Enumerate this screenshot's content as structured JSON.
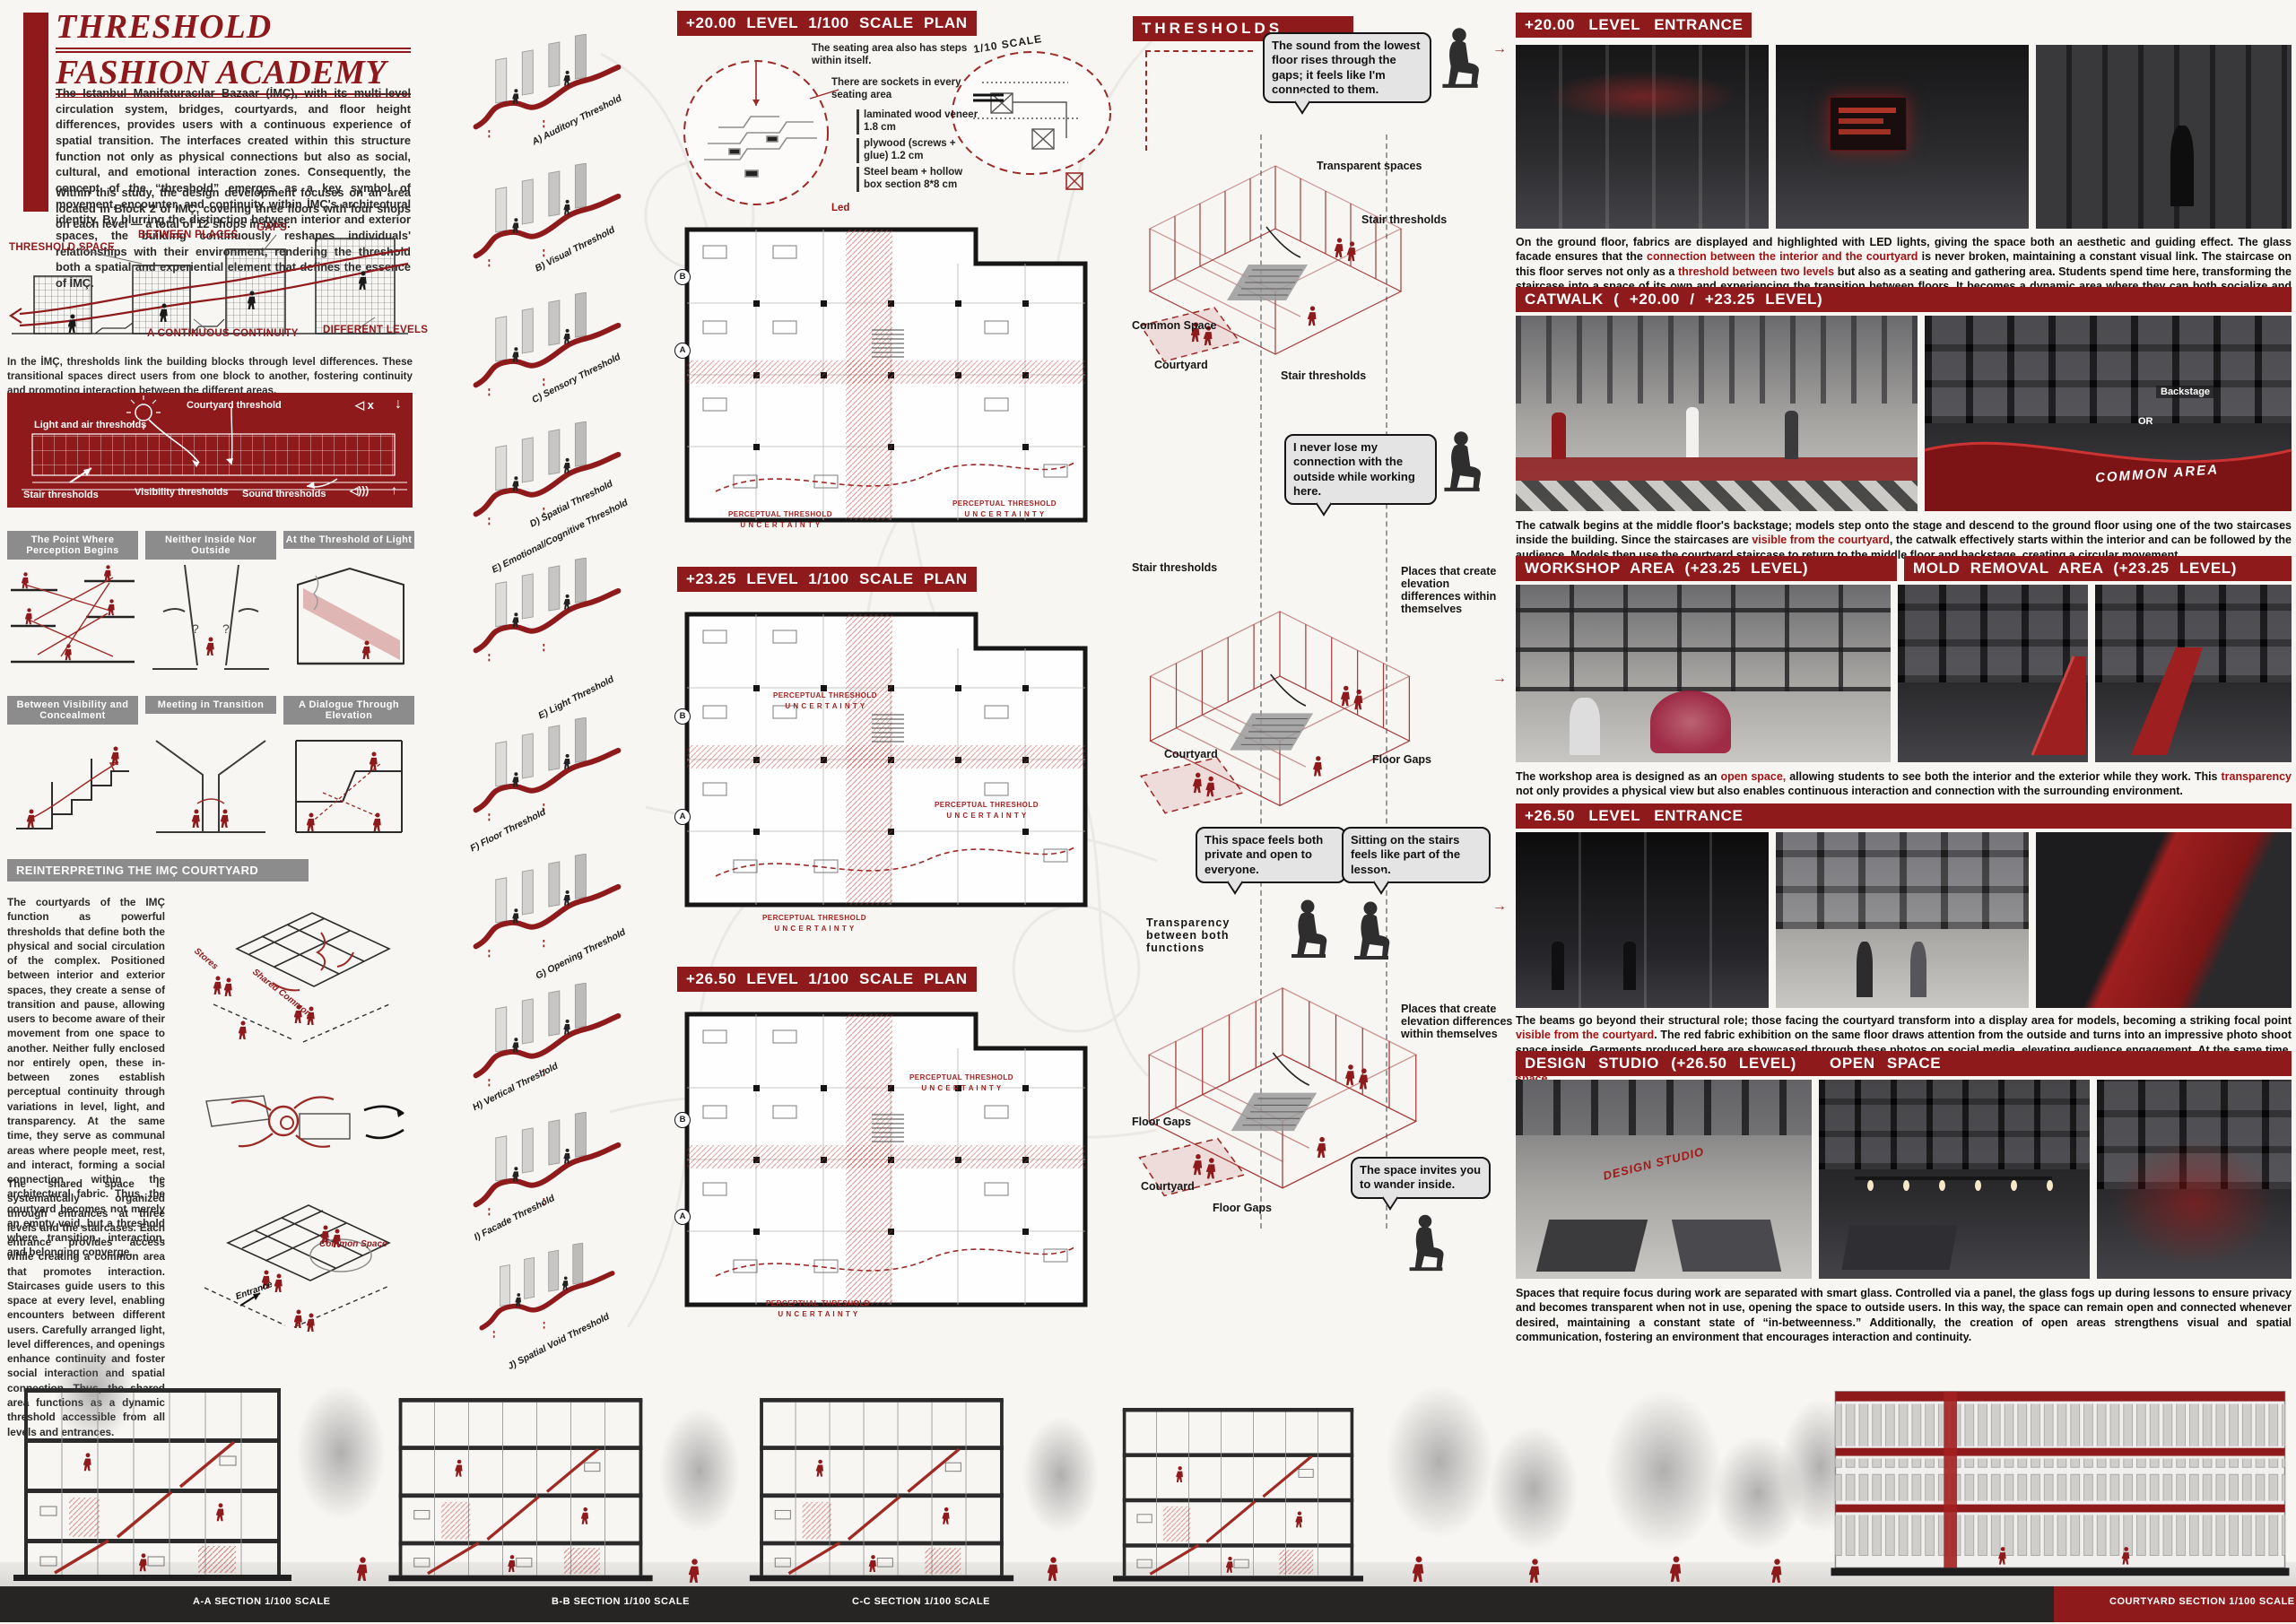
{
  "colors": {
    "maroon": "#8e1a1c",
    "sketch_red": "#9b2a26",
    "gray_header": "#8c8c8c"
  },
  "title": {
    "line1": "THRESHOLD",
    "line2": "FASHION ACADEMY"
  },
  "intro": {
    "p1": "The Istanbul Manifaturacılar Bazaar (İMÇ), with its multi-level circulation system, bridges, courtyards, and floor height differences, provides users with a continuous experience of spatial transition. The interfaces created within this structure function not only as physical connections but also as social, cultural, and emotional interaction zones. Consequently, the concept of the “threshold” emerges as a key symbol of movement, encounter, and continuity within İMÇ's architectural identity. By blurring the distinction between interior and exterior spaces, the building continuously reshapes individuals' relationships with their environment, rendering the threshold both a spatial and experiential element that defines the essence of İMÇ.",
    "p2": "Within this study, the design development focuses on an area located in Block 2 of İMÇ, covering three floors with four shops on each level — a total of 12 shops in total."
  },
  "concept": {
    "labels": [
      "THRESHOLD SPACE",
      "BETWEEN PLACES",
      "GAPS",
      "A CONTINUOUS CONTINUITY",
      "DIFFERENT LEVELS"
    ],
    "caption": "In the İMÇ, thresholds link the building blocks through level differences. These transitional spaces direct users from one block to another, fostering continuity and promoting interaction between the different areas."
  },
  "redband": {
    "labels": [
      "Courtyard threshold",
      "Light and air thresholds",
      "Stair thresholds",
      "Visibility thresholds",
      "Sound thresholds"
    ],
    "icon_mute": "◁ x",
    "icon_down": "↓",
    "icon_sound": "◁)))",
    "icon_up": "↑"
  },
  "panels": {
    "titles": [
      "The Point Where Perception Begins",
      "Neither Inside Nor Outside",
      "At the Threshold of Light",
      "Between Visibility and Concealment",
      "Meeting in Transition",
      "A Dialogue Through Elevation"
    ]
  },
  "reinterpret": {
    "title": "REINTERPRETING THE IMÇ COURTYARD",
    "p1": "The courtyards of the IMÇ function as powerful thresholds that define both the physical and social circulation of the complex. Positioned between interior and exterior spaces, they create a sense of transition and pause, allowing users to become aware of their movement from one space to another. Neither fully enclosed nor entirely open, these in-between zones establish perceptual continuity through variations in level, light, and transparency. At the same time, they serve as communal areas where people meet, rest, and interact, forming a social connection within the architectural fabric. Thus, the courtyard becomes not merely an empty void, but a threshold where transition, interaction, and belonging converge.",
    "p2": "The shared space is systematically organized through entrances at three levels and the staircases. Each entrance provides access while creating a common area that promotes interaction. Staircases guide users to this space at every level, enabling encounters between different users. Carefully arranged light, level differences, and openings enhance continuity and foster social interaction and spatial connection. Thus, the shared area functions as a dynamic threshold accessible from all levels and entrances.",
    "sk_stores": "Stores",
    "sk_shared": "Shared Common",
    "sk_common": "Common Space",
    "sk_entrance": "Entrance"
  },
  "axons": {
    "labels": [
      "A) Auditory Threshold",
      "B) Visual Threshold",
      "C) Sensory Threshold",
      "D) Spatial Threshold",
      "E) Emotional/Cognitive Threshold",
      "E) Light Threshold",
      "F) Floor Threshold",
      "G) Opening Threshold",
      "H) Vertical Threshold",
      "I) Facade Threshold",
      "J) Spatial Void Threshold"
    ]
  },
  "plans": {
    "p1_title": "+20.00 LEVEL 1/100 SCALE PLAN",
    "p2_title": "+23.25 LEVEL 1/100 SCALE PLAN",
    "p3_title": "+26.50 LEVEL 1/100 SCALE PLAN",
    "detail_scale": "1/10 SCALE",
    "note_steps": "The seating area also has steps within itself.",
    "note_sockets": "There are sockets in every seating area",
    "spec1": "laminated wood veneer 1.8 cm",
    "spec2": "plywood (screws + glue) 1.2 cm",
    "spec3": "Steel beam + hollow box section 8*8 cm",
    "led": "Led",
    "perceptual1": "PERCEPTUAL THRESHOLD",
    "perceptual2": "U N C E R T A I N T Y",
    "mark_a": "A",
    "mark_b": "B"
  },
  "thresholds": {
    "title": "THRESHOLDS",
    "bubble1": "The sound from the lowest floor rises through the gaps; it feels like I'm connected to them.",
    "bubble2": "I never lose my connection with the outside while working here.",
    "bubble3": "This space feels both private and open to everyone.",
    "bubble4": "Sitting on the stairs feels like part of the lesson.",
    "bubble5": "The space invites you to wander inside.",
    "l_transparent": "Transparent spaces",
    "l_stair": "Stair thresholds",
    "l_common": "Common Space",
    "l_courtyard": "Courtyard",
    "l_elev": "Places that create elevation differences within themselves",
    "l_floorgaps": "Floor Gaps",
    "l_transparency": "Transparency between both functions"
  },
  "right": {
    "h_entrance20": "+20.00 LEVEL ENTRANCE",
    "h_catwalk": "CATWALK ( +20.00 / +23.25 LEVEL)",
    "h_workshop": "WORKSHOP AREA (+23.25 LEVEL)",
    "h_mold": "MOLD REMOVAL AREA (+23.25 LEVEL)",
    "h_entrance26": "+26.50 LEVEL ENTRANCE",
    "h_design": "DESIGN STUDIO (+26.50 LEVEL)",
    "h_open": "OPEN SPACE",
    "photo_backstage": "Backstage",
    "photo_or": "OR",
    "photo_common": "COMMON AREA",
    "photo_design": "DESIGN STUDIO",
    "p1": [
      {
        "t": "On the ground floor, fabrics are displayed and highlighted with LED lights, giving the space both an aesthetic and guiding effect. The glass facade ensures that the "
      },
      {
        "t": "connection between the interior and the courtyard",
        "r": true
      },
      {
        "t": " is never broken, maintaining a constant visual link. The staircase on this floor serves not only as a "
      },
      {
        "t": "threshold between two levels",
        "r": true
      },
      {
        "t": " but also as a seating and gathering area. Students spend time here, transforming the staircase into a space of its own and experiencing the transition between floors. It becomes a dynamic area where they can both socialize and carry out activities such as sketches and other creative work."
      }
    ],
    "p2": [
      {
        "t": "The catwalk begins at the middle floor's backstage; models step onto the stage and descend to the ground floor using one of the two staircases inside the building. Since the staircases are "
      },
      {
        "t": "visible from the courtyard",
        "r": true
      },
      {
        "t": ", the catwalk effectively starts within the interior and can be followed by the audience. Models then use the courtyard staircase to return to the middle floor and backstage, creating a circular movement."
      }
    ],
    "p3": [
      {
        "t": "The workshop area is designed as an "
      },
      {
        "t": "open space,",
        "r": true
      },
      {
        "t": " allowing students to see both the interior and the exterior while they work. This "
      },
      {
        "t": "transparency",
        "r": true
      },
      {
        "t": " not only provides a physical view but also enables continuous interaction and connection with the surrounding environment."
      }
    ],
    "p4": [
      {
        "t": "The beams go beyond their structural role; those facing the courtyard transform into a display area for models, becoming a striking focal point "
      },
      {
        "t": "visible from the courtyard",
        "r": true
      },
      {
        "t": ". The red fabric exhibition on the same floor draws attention from the outside and turns into an impressive photo shoot space inside. Garments produced here are showcased through these photos on social media, elevating audience engagement. At the same time, the floor openings created in the central area enhance "
      },
      {
        "t": "communication between floors and strengthen the visual and auditory continuity of the space.",
        "r": true
      }
    ],
    "p5": [
      {
        "t": "Spaces that require focus during work are separated with smart glass. Controlled via a panel, the glass fogs up during lessons to ensure privacy and becomes transparent when not in use, opening the space to outside users. In this way, the space can remain open and connected whenever desired, maintaining a constant state of “in-betweenness.” Additionally, the creation of open areas strengthens visual and spatial communication, fostering an environment that encourages interaction and continuity."
      }
    ]
  },
  "sections": {
    "a": "A-A SECTION 1/100 SCALE",
    "b": "B-B SECTION 1/100 SCALE",
    "c": "C-C SECTION 1/100 SCALE",
    "courtyard": "COURTYARD SECTION 1/100 SCALE"
  }
}
